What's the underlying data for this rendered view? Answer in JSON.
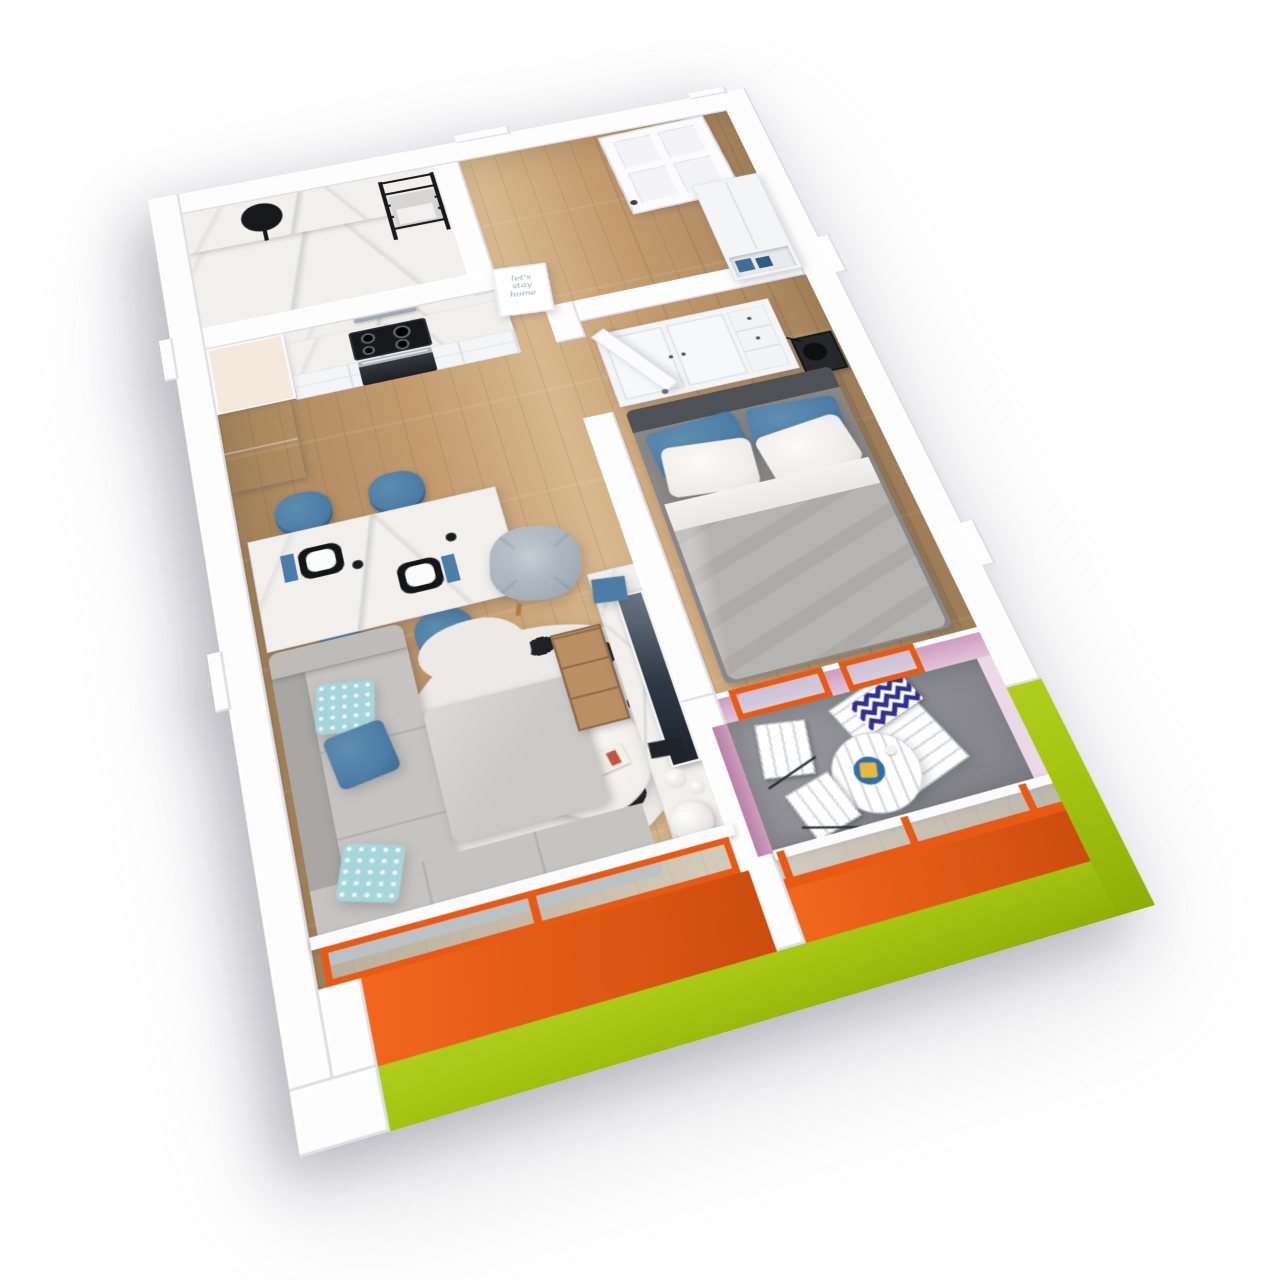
{
  "scene": {
    "poster": {
      "line1": "let's",
      "line2": "stay",
      "line3": "home"
    }
  },
  "colors": {
    "wall": "#fdfdfe",
    "wood": "#c39b6f",
    "wood_dark": "#a8855c",
    "wood_light": "#d8b88e",
    "marble": "#f2f0ed",
    "accent_orange": "#e85a14",
    "accent_orange_dark": "#cc4c0e",
    "facade_green": "#a6c511",
    "balcony_pink": "#cf9cc0",
    "balcony_pink_light": "#ecd9e7",
    "balcony_floor": "#8d8d93",
    "upholstery_blue": "#4c7da6",
    "pillow_teal": "#a5d6da",
    "sofa_gray": "#c6c4c1",
    "sofa_gray_dark": "#a9a7a4",
    "bed_gray": "#b6b4b1",
    "headboard": "#4e5257",
    "black": "#1f2125",
    "steel": "#aeb6bd",
    "fridge": "#9aa3ae",
    "cream": "#f4e9dc",
    "rug_white": "#eceae7",
    "chevron_navy": "#2e3192",
    "plate_navy": "#2f6fa8",
    "plate_yellow": "#e8b93c"
  }
}
